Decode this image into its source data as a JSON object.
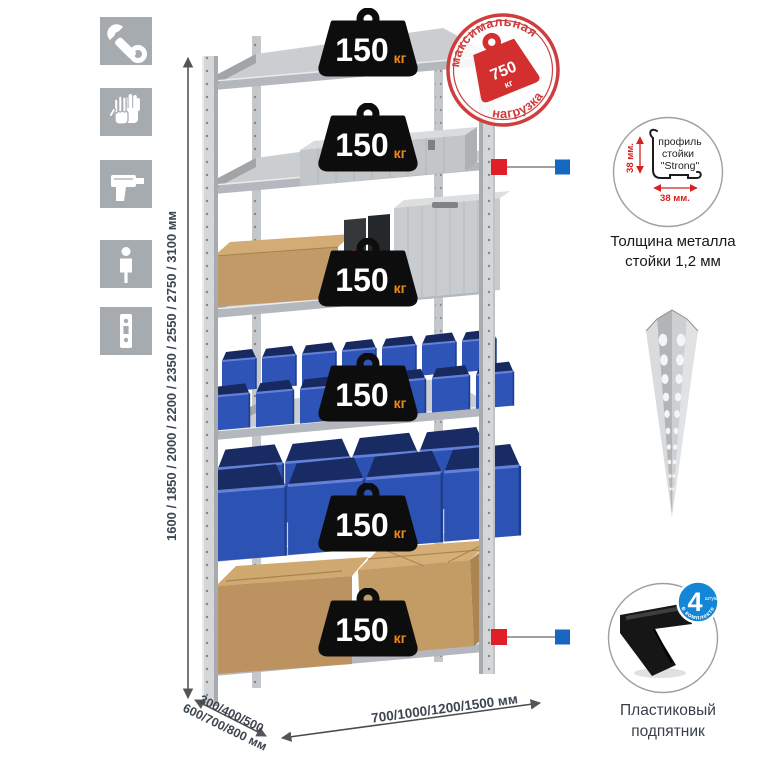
{
  "colors": {
    "accent_red": "#cf3e3e",
    "connector_red": "#e01f26",
    "connector_blue": "#1567c0",
    "bin_blue": "#2d54b6",
    "metal_gray": "#cbced1",
    "cardboard": "#c19a67",
    "badge_black": "#0d0d0d",
    "kg_orange": "#ee8a1d",
    "dimension_text": "#3e4651",
    "icon_gray": "#a6abb0",
    "foot_badge_blue": "#1486d8"
  },
  "feature_icons": [
    {
      "name": "wrench"
    },
    {
      "name": "gloves"
    },
    {
      "name": "drill"
    },
    {
      "name": "person"
    },
    {
      "name": "post-profile"
    }
  ],
  "dimensions": {
    "height": "1600 / 1850 / 2000 / 2200 / 2350 / 2550 / 2750 / 3100 мм",
    "depth_line1": "300/400/500",
    "depth_line2": "600/700/800 мм",
    "width": "700/1000/1200/1500 мм"
  },
  "shelf_load": {
    "value": "150",
    "unit": "кг",
    "shelves": 6
  },
  "max_load_stamp": {
    "arc_top": "максимальная",
    "arc_bottom": "нагрузка",
    "value": "750",
    "unit": "кг"
  },
  "profile_detail": {
    "label_line1": "профиль",
    "label_line2": "стойки",
    "label_line3": "\"Strong\"",
    "dim_vertical": "38 мм.",
    "dim_horizontal": "38 мм.",
    "caption_line1": "Толщина металла",
    "caption_line2": "стойки 1,2 мм"
  },
  "foot_detail": {
    "badge_value": "4",
    "badge_unit": "штуки",
    "badge_arc": "в комплекте",
    "caption_line1": "Пластиковый",
    "caption_line2": "подпятник"
  }
}
